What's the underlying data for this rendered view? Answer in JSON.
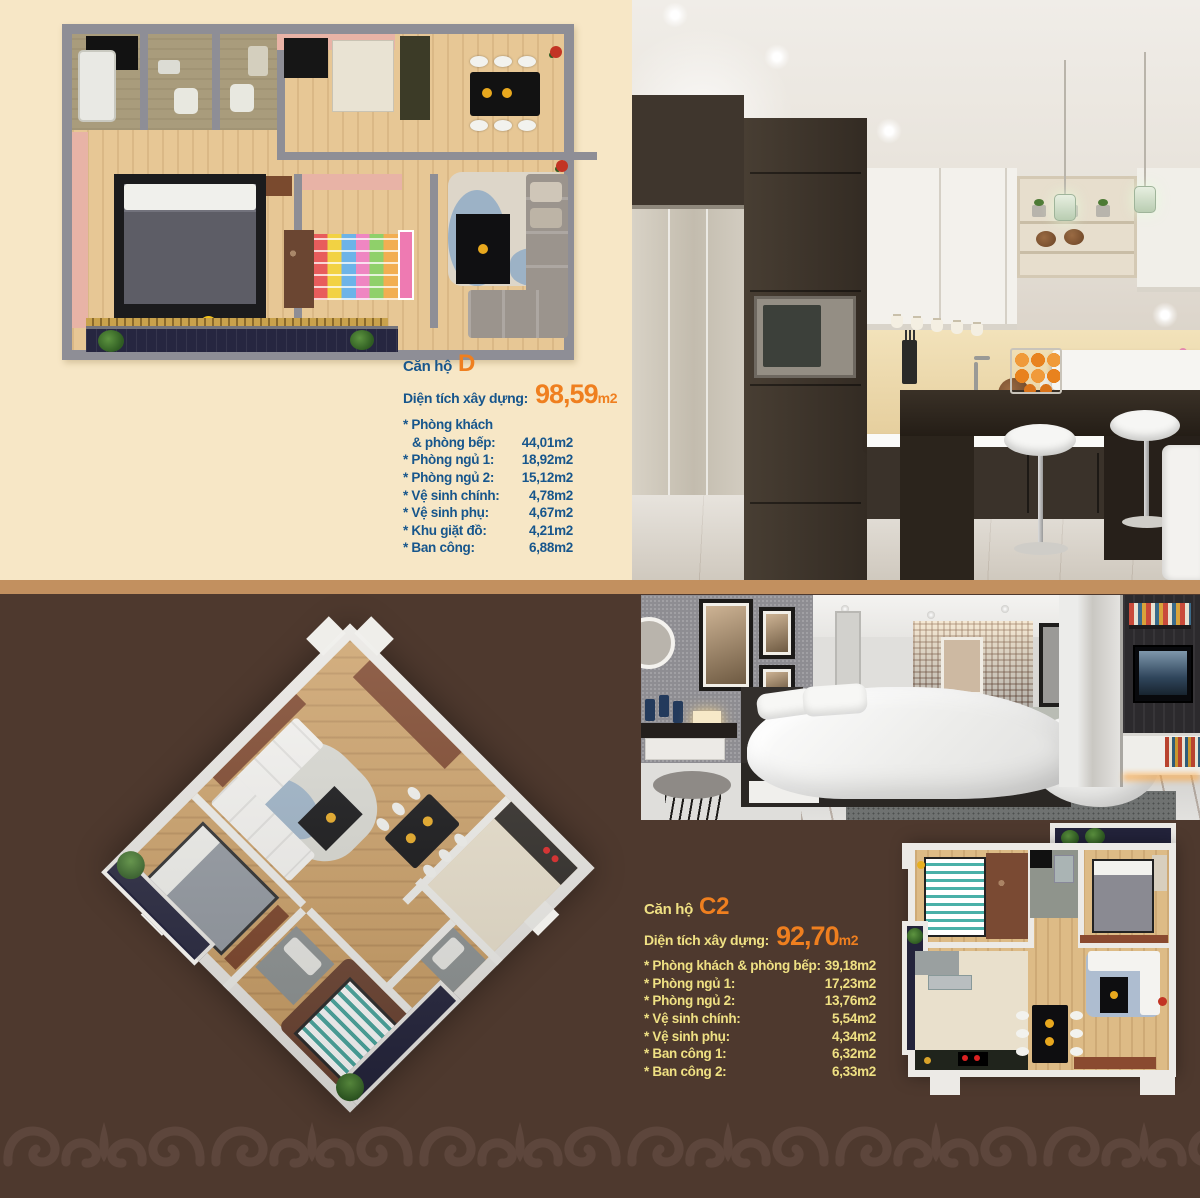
{
  "apartment_d": {
    "title": "Căn hộ",
    "code": "D",
    "area_label": "Diện tích xây dựng:",
    "area_value": "98,59",
    "area_unit": "m2",
    "rooms": [
      {
        "label": "* Phòng khách",
        "value": ""
      },
      {
        "label": "& phòng bếp:",
        "value": "44,01m2",
        "indent": true
      },
      {
        "label": "* Phòng ngủ 1:",
        "value": "18,92m2"
      },
      {
        "label": "* Phòng ngủ 2:",
        "value": "15,12m2"
      },
      {
        "label": "* Vệ sinh chính:",
        "value": "4,78m2"
      },
      {
        "label": "* Vệ sinh phụ:",
        "value": "4,67m2"
      },
      {
        "label": "* Khu giặt đồ:",
        "value": "4,21m2"
      },
      {
        "label": "* Ban công:",
        "value": "6,88m2"
      }
    ]
  },
  "apartment_c2": {
    "title": "Căn hộ",
    "code": "C2",
    "area_label": "Diện tích xây dựng:",
    "area_value": "92,70",
    "area_unit": "m2",
    "rooms": [
      {
        "label": "* Phòng khách & phòng bếp:",
        "value": "39,18m2"
      },
      {
        "label": "* Phòng ngủ 1:",
        "value": "17,23m2"
      },
      {
        "label": "* Phòng ngủ 2:",
        "value": "13,76m2"
      },
      {
        "label": "* Vệ sinh chính:",
        "value": "5,54m2"
      },
      {
        "label": "* Vệ sinh phụ:",
        "value": "4,34m2"
      },
      {
        "label": "* Ban công 1:",
        "value": "6,32m2"
      },
      {
        "label": "* Ban công 2:",
        "value": "6,33m2"
      }
    ]
  },
  "colors": {
    "top_background": "#f7e7c6",
    "bottom_background": "#4e392e",
    "divider": "#c2905f",
    "heading_blue": "#17568c",
    "heading_yellow": "#efe083",
    "accent_orange": "#ef7f1f",
    "balcony_navy": "#23233b",
    "scroll_pattern": "#5d463c"
  }
}
